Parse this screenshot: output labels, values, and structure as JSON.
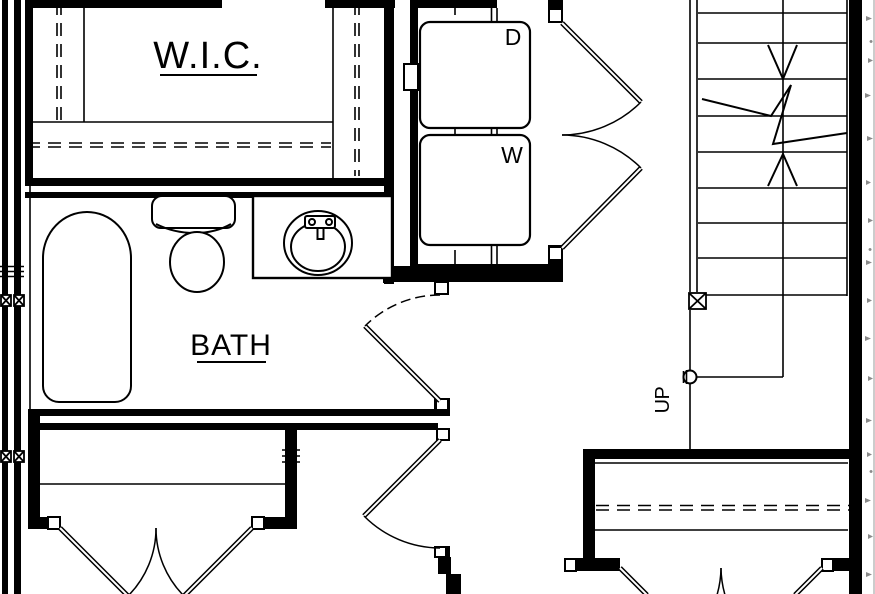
{
  "drawing": {
    "type": "architectural floor plan detail",
    "background_color": "#ffffff",
    "line_color": "#000000",
    "hatch_color": "#8a8a8a"
  },
  "rooms": {
    "walk_in_closet": {
      "label": "W.I.C."
    },
    "bathroom": {
      "label": "BATH"
    }
  },
  "appliances": {
    "dryer": {
      "label": "D"
    },
    "washer": {
      "label": "W"
    }
  },
  "stairs": {
    "direction_label": "UP"
  }
}
